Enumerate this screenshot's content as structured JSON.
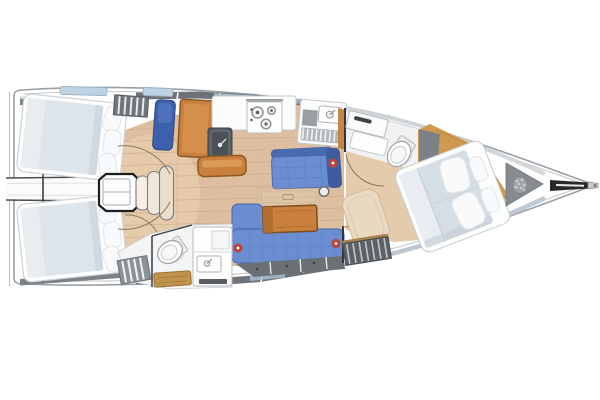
{
  "meta": {
    "type": "yacht-interior-floor-plan",
    "view": "top-down",
    "bow_direction": "right",
    "stern_direction": "left"
  },
  "areas": [
    {
      "id": "aft-cabin-port",
      "role": "double berth cabin, port quarter"
    },
    {
      "id": "aft-cabin-starboard",
      "role": "double berth cabin, starboard quarter"
    },
    {
      "id": "companionway",
      "role": "engine box and entry steps"
    },
    {
      "id": "aft-head",
      "role": "bathroom with toilet, sink vanity, shower grate"
    },
    {
      "id": "nav-station",
      "role": "chart table with navy seat"
    },
    {
      "id": "galley",
      "role": "stove, twin sink, drainer counter"
    },
    {
      "id": "salon-settee-port",
      "role": "straight blue settee"
    },
    {
      "id": "salon-settee-starboard",
      "role": "L-shaped blue settee with wood table"
    },
    {
      "id": "mast-post",
      "role": "compression post"
    },
    {
      "id": "forward-head",
      "role": "bathroom with toilet and counter"
    },
    {
      "id": "forward-cabin",
      "role": "owner V-berth with pillows"
    },
    {
      "id": "anchor-locker",
      "role": "chain locker at bow"
    },
    {
      "id": "bow-roller",
      "role": "anchor roller fitting"
    }
  ],
  "colors": {
    "hull_stroke": "#9aa0a5",
    "deck_band": "#6e7276",
    "wedge_gray": "#7d8286",
    "hatch_blue": "#a9c2d6",
    "berth": "#dde5ea",
    "bed": "#d6dee5",
    "sheet": "#e9edf1",
    "pillow": "#f9fafb",
    "floor": "#ddbf9f",
    "floor_line": "#c8a685",
    "corridor": "#e4cbac",
    "wood": "#cf9a50",
    "wood_line": "#b5813c",
    "table_orange": "#c9803d",
    "table_border": "#7d4e1f",
    "settee": "#6b8ed2",
    "settee_dark": "#44639f",
    "nav_seat": "#3c60ab",
    "button_red": "#b7463c",
    "locker_gray": "#6b7074",
    "slat_dark": "#5d6267",
    "sink_dark": "#565c63",
    "head_floor": "#f3f4f5",
    "beige_seat": "#ead9c1",
    "step_wood": "#c2934a",
    "chain_gray": "#9aa0a4",
    "roller_black": "#26282a"
  }
}
